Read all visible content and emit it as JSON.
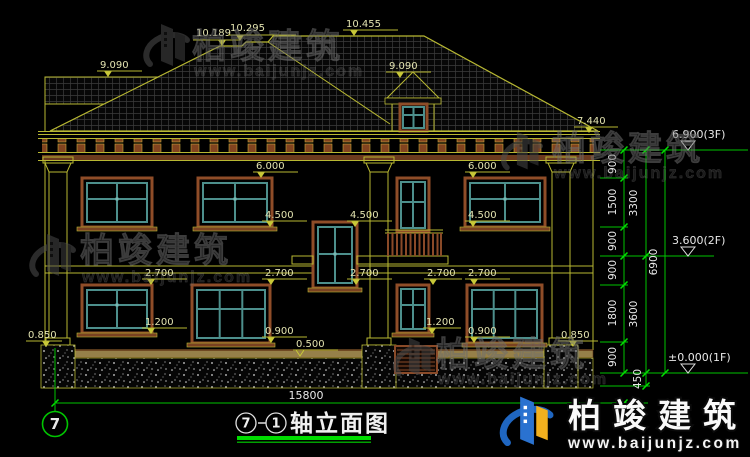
{
  "title": {
    "axis_left": "7",
    "axis_right": "1",
    "name": "轴立面图"
  },
  "axis_bubble_label": "7",
  "dims": {
    "total_width": "15800",
    "heights_inner": [
      "900",
      "1500",
      "900",
      "900",
      "1800",
      "900"
    ],
    "heights_mid": [
      "3300",
      "3600",
      "450"
    ],
    "height_total": "6900"
  },
  "elevations": {
    "ridge_left": "10.189",
    "ridge_mid": "10.295",
    "ridge_top": "10.455",
    "left_roof": "9.090",
    "dormer_roof": "9.090",
    "eave": "7.440",
    "floor3": "6.900(3F)",
    "floor2": "3.600(2F)",
    "floor1": "±0.000(1F)",
    "window_head_2f": "6.000",
    "window_sill_2f": "4.500",
    "window_head_1f": "2.700",
    "window_sill_1f_high": "1.200",
    "window_sill_1f_low": "0.900",
    "plinth_top": "0.850",
    "wall_base": "0.500"
  },
  "watermark": {
    "company": "柏竣建筑",
    "website": "www.baijunjz.com"
  },
  "brand_footer": {
    "company": "柏竣建筑",
    "website": "www.baijunjz.com"
  },
  "colors": {
    "background": "#000000",
    "linework_yellow": "#b8b832",
    "dimension_green": "#00c400",
    "text_white": "#e8e8e8",
    "window_frame_brown": "#8f4d28",
    "window_frame_teal": "#4d8f8c",
    "title_underline_green": "#00dc00",
    "logo_blue": "#1f66c1",
    "logo_yellow": "#f2b01e"
  }
}
